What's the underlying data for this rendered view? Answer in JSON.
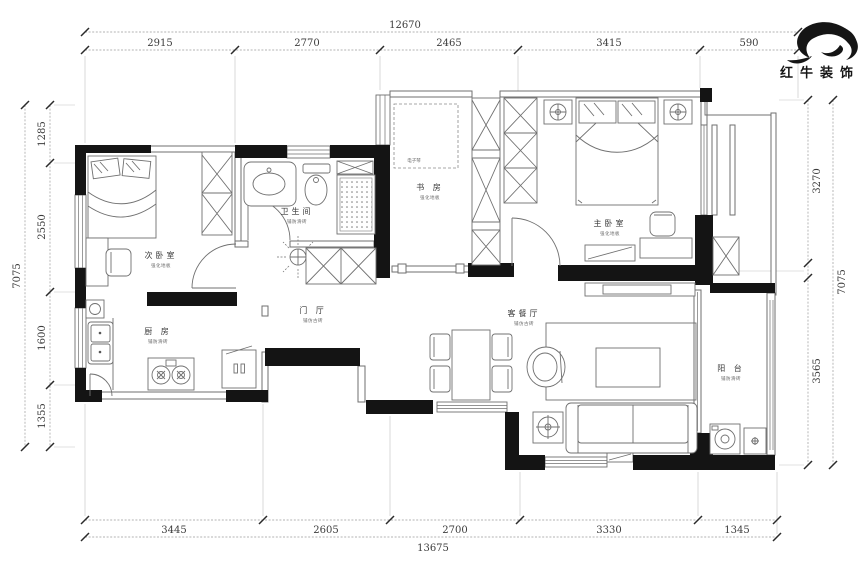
{
  "brand": {
    "logo_text": "红牛装饰"
  },
  "dimensions": {
    "top": {
      "total": "12670",
      "segments": [
        "2915",
        "2770",
        "2465",
        "3415",
        "590"
      ]
    },
    "bottom": {
      "total": "13675",
      "segments": [
        "3445",
        "2605",
        "2700",
        "3330",
        "1345"
      ]
    },
    "left": {
      "total": "7075",
      "segments": [
        "1285",
        "2550",
        "1600",
        "1355"
      ]
    },
    "right": {
      "total": "7075",
      "segments": [
        "3270",
        "3565"
      ]
    }
  },
  "rooms": {
    "secondary_bedroom": {
      "name": "次卧室",
      "note": "强化地板"
    },
    "bathroom": {
      "name": "卫生间",
      "note": "铺防滑砖"
    },
    "study": {
      "name": "书 房",
      "note": "强化地板"
    },
    "master_bedroom": {
      "name": "主卧室",
      "note": "强化地板"
    },
    "hallway": {
      "name": "门 厅",
      "note": "铺仿古砖"
    },
    "kitchen": {
      "name": "厨 房",
      "note": "铺防滑砖"
    },
    "living_dining": {
      "name": "客餐厅",
      "note": "铺仿古砖"
    },
    "balcony": {
      "name": "阳 台",
      "note": "铺防滑砖"
    }
  },
  "annotations": {
    "study_item": "电子琴"
  },
  "colors": {
    "wall": "#141414",
    "line": "#707070",
    "dim": "#3c3c3c",
    "logo": "#151515"
  }
}
